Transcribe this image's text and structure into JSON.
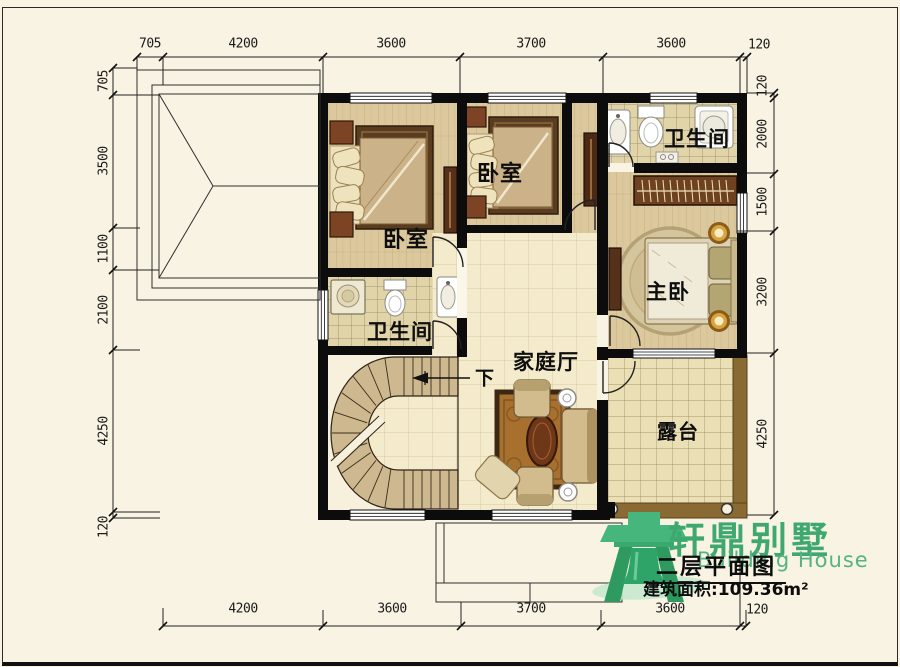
{
  "rooms": {
    "bedroom_left": "卧室",
    "bedroom_mid": "卧室",
    "bathroom_top": "卫生间",
    "bathroom_left": "卫生间",
    "master_bedroom": "主卧",
    "family_hall": "家庭厅",
    "terrace": "露台",
    "stairs_direction": "下"
  },
  "dimensions": {
    "top": [
      "705",
      "4200",
      "3600",
      "3700",
      "3600",
      "120"
    ],
    "left": [
      "705",
      "3500",
      "1100",
      "2100",
      "4250",
      "120"
    ],
    "right": [
      "120",
      "2000",
      "1500",
      "3200",
      "4250"
    ],
    "bottom": [
      "4200",
      "3600",
      "3700",
      "3600",
      "120"
    ]
  },
  "title_block": {
    "brand_cn": "轩鼎别墅",
    "brand_en": "Building House",
    "drawing_title": "二层平面图",
    "area_text": "建筑面积:109.36m²"
  },
  "colors": {
    "background": "#f8f3e2",
    "wall": "#0c0c0c",
    "brand_green": "#3fa871",
    "wood_floor": "#dcc89d",
    "tile_small": "#e2d4a9",
    "tile_large": "#f4ebcd",
    "terrace_tile": "#ebdfb5",
    "terrace_frame": "#8a6a33",
    "stair": "#cdb88f"
  }
}
